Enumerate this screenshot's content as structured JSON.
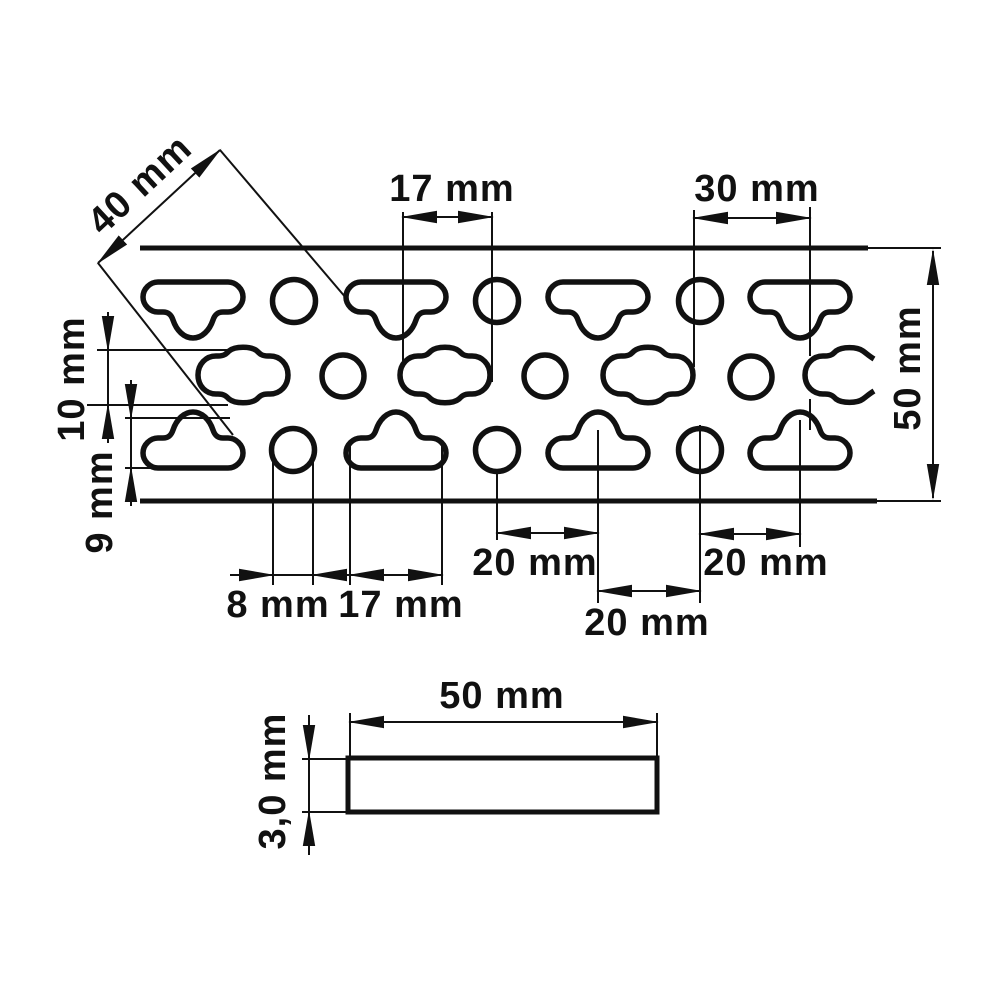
{
  "page": {
    "background": "#ffffff",
    "line_color": "#111111"
  },
  "labels": {
    "diagonal_pitch": "40 mm",
    "top_slot_width": "17 mm",
    "top_hole_spacing": "30 mm",
    "strip_width": "50 mm",
    "middle_hole_height": "10 mm",
    "bottom_hole_height": "9 mm",
    "hole_diameter": "8 mm",
    "bottom_slot_width": "17 mm",
    "spacing_circle_to_slot": "20 mm",
    "spacing_slot_to_circle": "20 mm",
    "spacing_circle_to_slot_right": "20 mm",
    "section_width": "50 mm",
    "section_thickness": "3,0 mm"
  }
}
